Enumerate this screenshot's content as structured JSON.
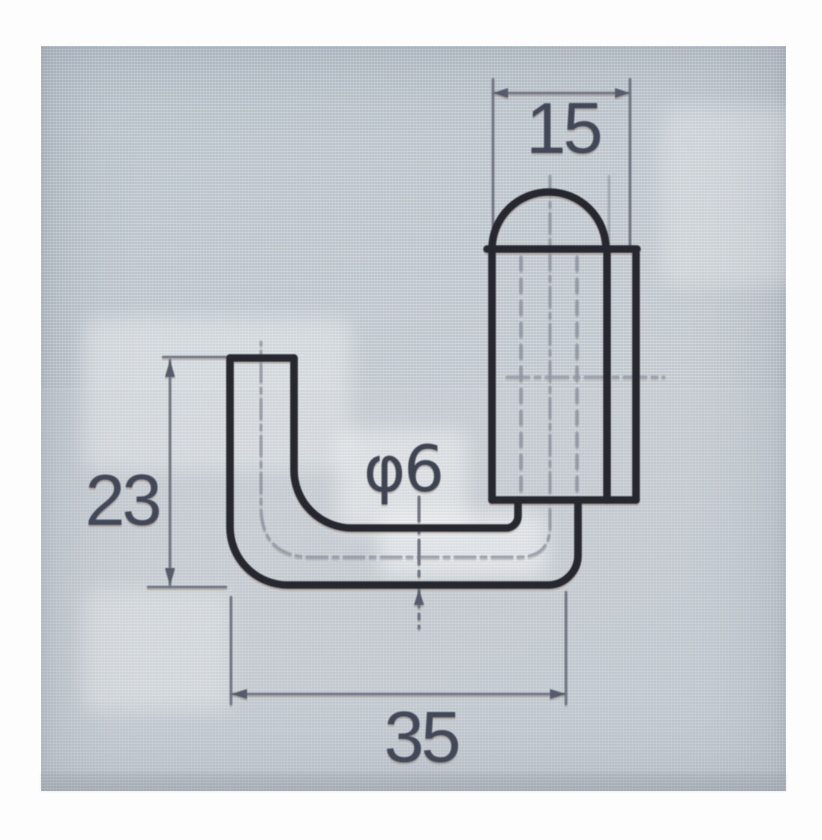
{
  "photo": {
    "background_color": "#c2cbd2",
    "outline_color": "#26272f",
    "dimension_line_color": "#6f7585",
    "text_color": "#424858",
    "margin_color": "#ffffff"
  },
  "drawing": {
    "dimensions": {
      "top_width": "15",
      "left_height": "23",
      "bottom_width": "35",
      "rod_diameter": "φ6"
    }
  }
}
